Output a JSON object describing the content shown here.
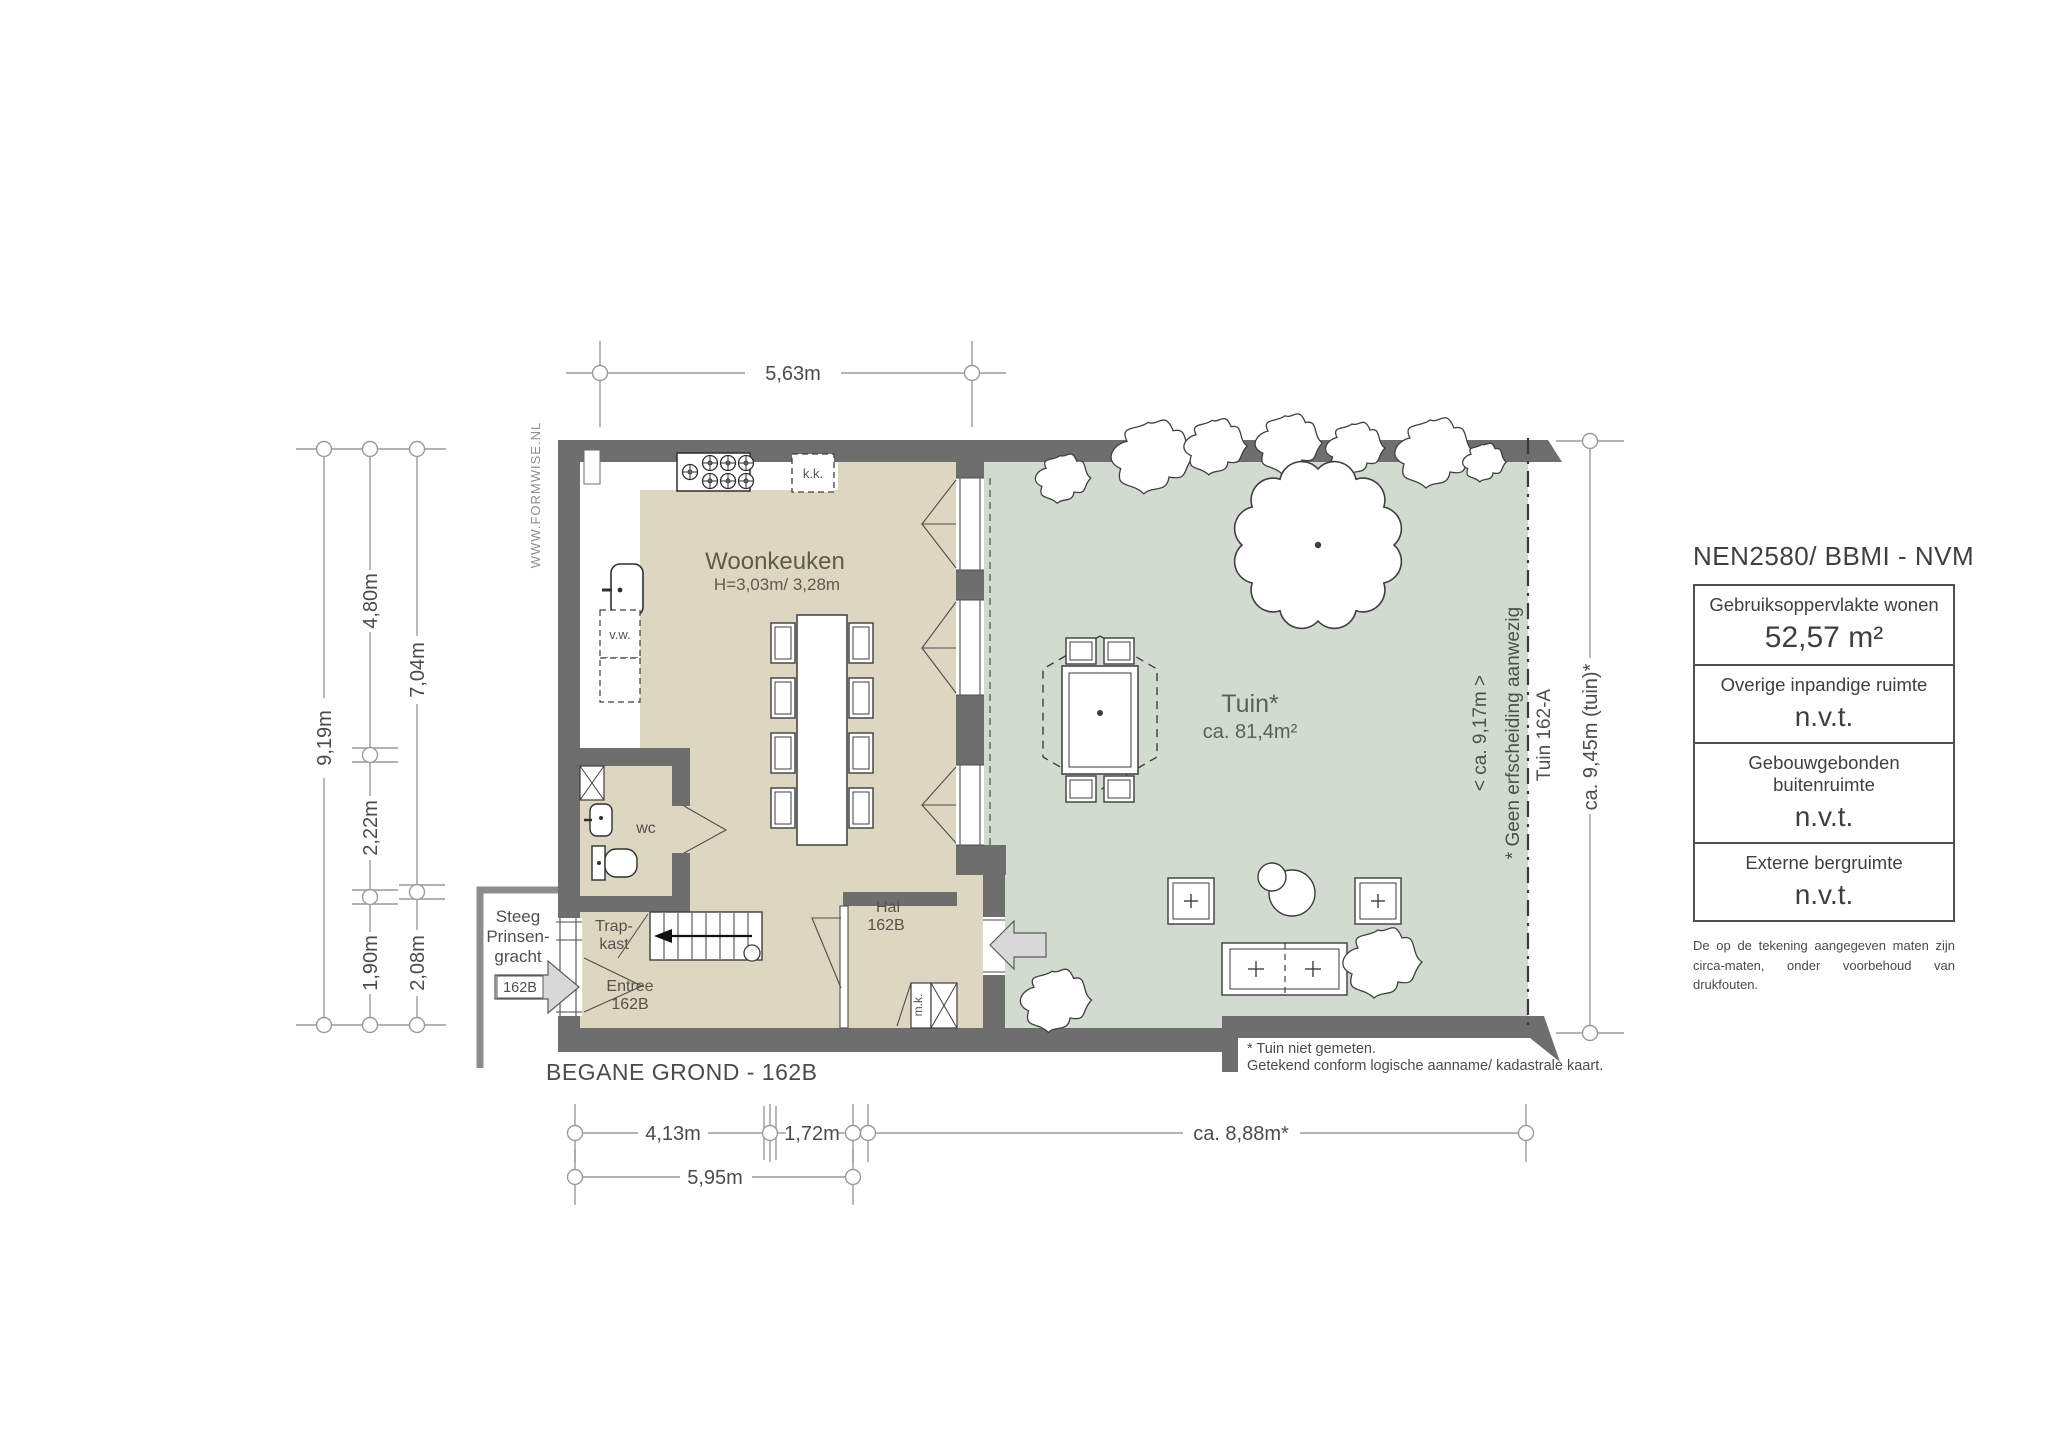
{
  "title": "BEGANE GROND - 162B",
  "watermark": "WWW.FORMWISE.NL",
  "rooms": {
    "woonkeuken": {
      "name": "Woonkeuken",
      "ceiling": "H=3,03m/ 3,28m"
    },
    "tuin": {
      "name": "Tuin*",
      "area": "ca. 81,4m²"
    },
    "wc": "wc",
    "trapkast": {
      "line1": "Trap-",
      "line2": "kast"
    },
    "entree": {
      "line1": "Entree",
      "line2": "162B"
    },
    "hal": {
      "line1": "Hal",
      "line2": "162B"
    },
    "vw": "v.w.",
    "kk": "k.k.",
    "mk": "m.k."
  },
  "street": {
    "line1": "Steeg",
    "line2": "Prinsen-",
    "line3": "gracht",
    "entrance_label": "162B"
  },
  "dimensions": {
    "top": "5,63m",
    "left_total": "9,19m",
    "left_a1": "4,80m",
    "left_a2": "2,22m",
    "left_a3": "1,90m",
    "left_b1": "7,04m",
    "left_b2": "2,08m",
    "bottom_a1": "4,13m",
    "bottom_a2": "1,72m",
    "bottom_garden": "ca. 8,88m*",
    "bottom_total": "5,95m",
    "right_garden": "ca. 9,45m (tuin)*",
    "garden_inner": "< ca. 9,17m >"
  },
  "garden_annotations": {
    "fence_note": "* Geen erfscheiding aanwezig",
    "neighbor_garden": "Tuin 162-A"
  },
  "footnotes": {
    "line1": "* Tuin niet gemeten.",
    "line2": "Getekend conform logische aanname/ kadastrale kaart."
  },
  "info_panel": {
    "heading": "NEN2580/ BBMI - NVM",
    "rows": [
      {
        "label": "Gebruiksoppervlakte wonen",
        "value": "52,57 m²"
      },
      {
        "label": "Overige inpandige ruimte",
        "value": "n.v.t."
      },
      {
        "label": "Gebouwgebonden buitenruimte",
        "value": "n.v.t."
      },
      {
        "label": "Externe bergruimte",
        "value": "n.v.t."
      }
    ],
    "disclaimer_line1": "De op de tekening aangegeven maten zijn",
    "disclaimer_line2": "circa-maten, onder voorbehoud van drukfouten."
  },
  "colors": {
    "wall": "#6e6e6e",
    "floor": "#ddd7c1",
    "garden": "#d2dbd0",
    "dimension": "#9a9a9a",
    "text": "#4b4b4b"
  }
}
